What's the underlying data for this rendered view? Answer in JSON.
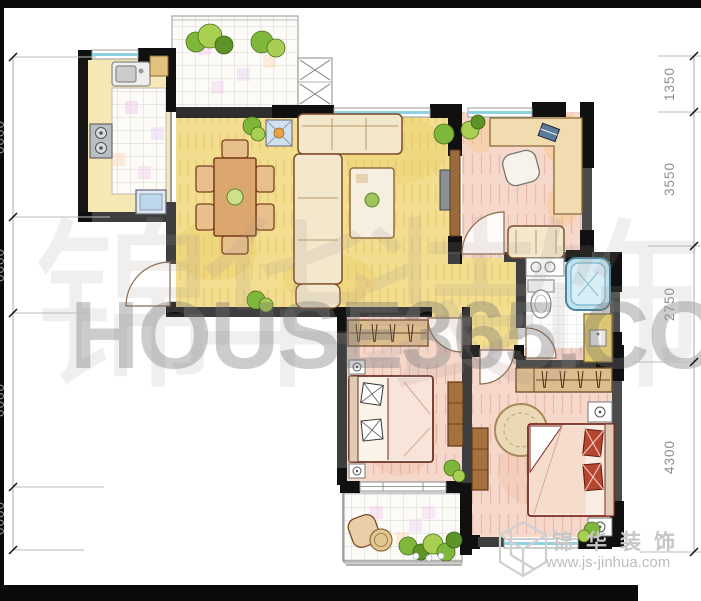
{
  "watermark": {
    "site": "HOUSE365.COM",
    "site_cjk": "锦华装饰",
    "brand_cjk": "锦华装饰",
    "brand_url": "www.js-jinhua.com"
  },
  "dimensions": {
    "right": [
      {
        "label": "1350"
      },
      {
        "label": "3550"
      },
      {
        "label": "2750"
      },
      {
        "label": "4300"
      }
    ],
    "left_clipped": [
      {
        "label": "0000"
      },
      {
        "label": "0000"
      },
      {
        "label": "0000"
      },
      {
        "label": "0000"
      }
    ]
  },
  "colors": {
    "wall_gray": "#3e3e3e",
    "wall_black": "#101010",
    "floor_yellow": "#f2de8e",
    "floor_pink": "#f6d8cb",
    "window_cyan": "#8ed1e0",
    "tub_blue": "#bfe2ee",
    "vanity_marble": "#e6cf6e",
    "furniture_tan": "#dcbd8e",
    "plant_green": "#7fb73b",
    "watermark_gray": "#c6c6c6"
  }
}
